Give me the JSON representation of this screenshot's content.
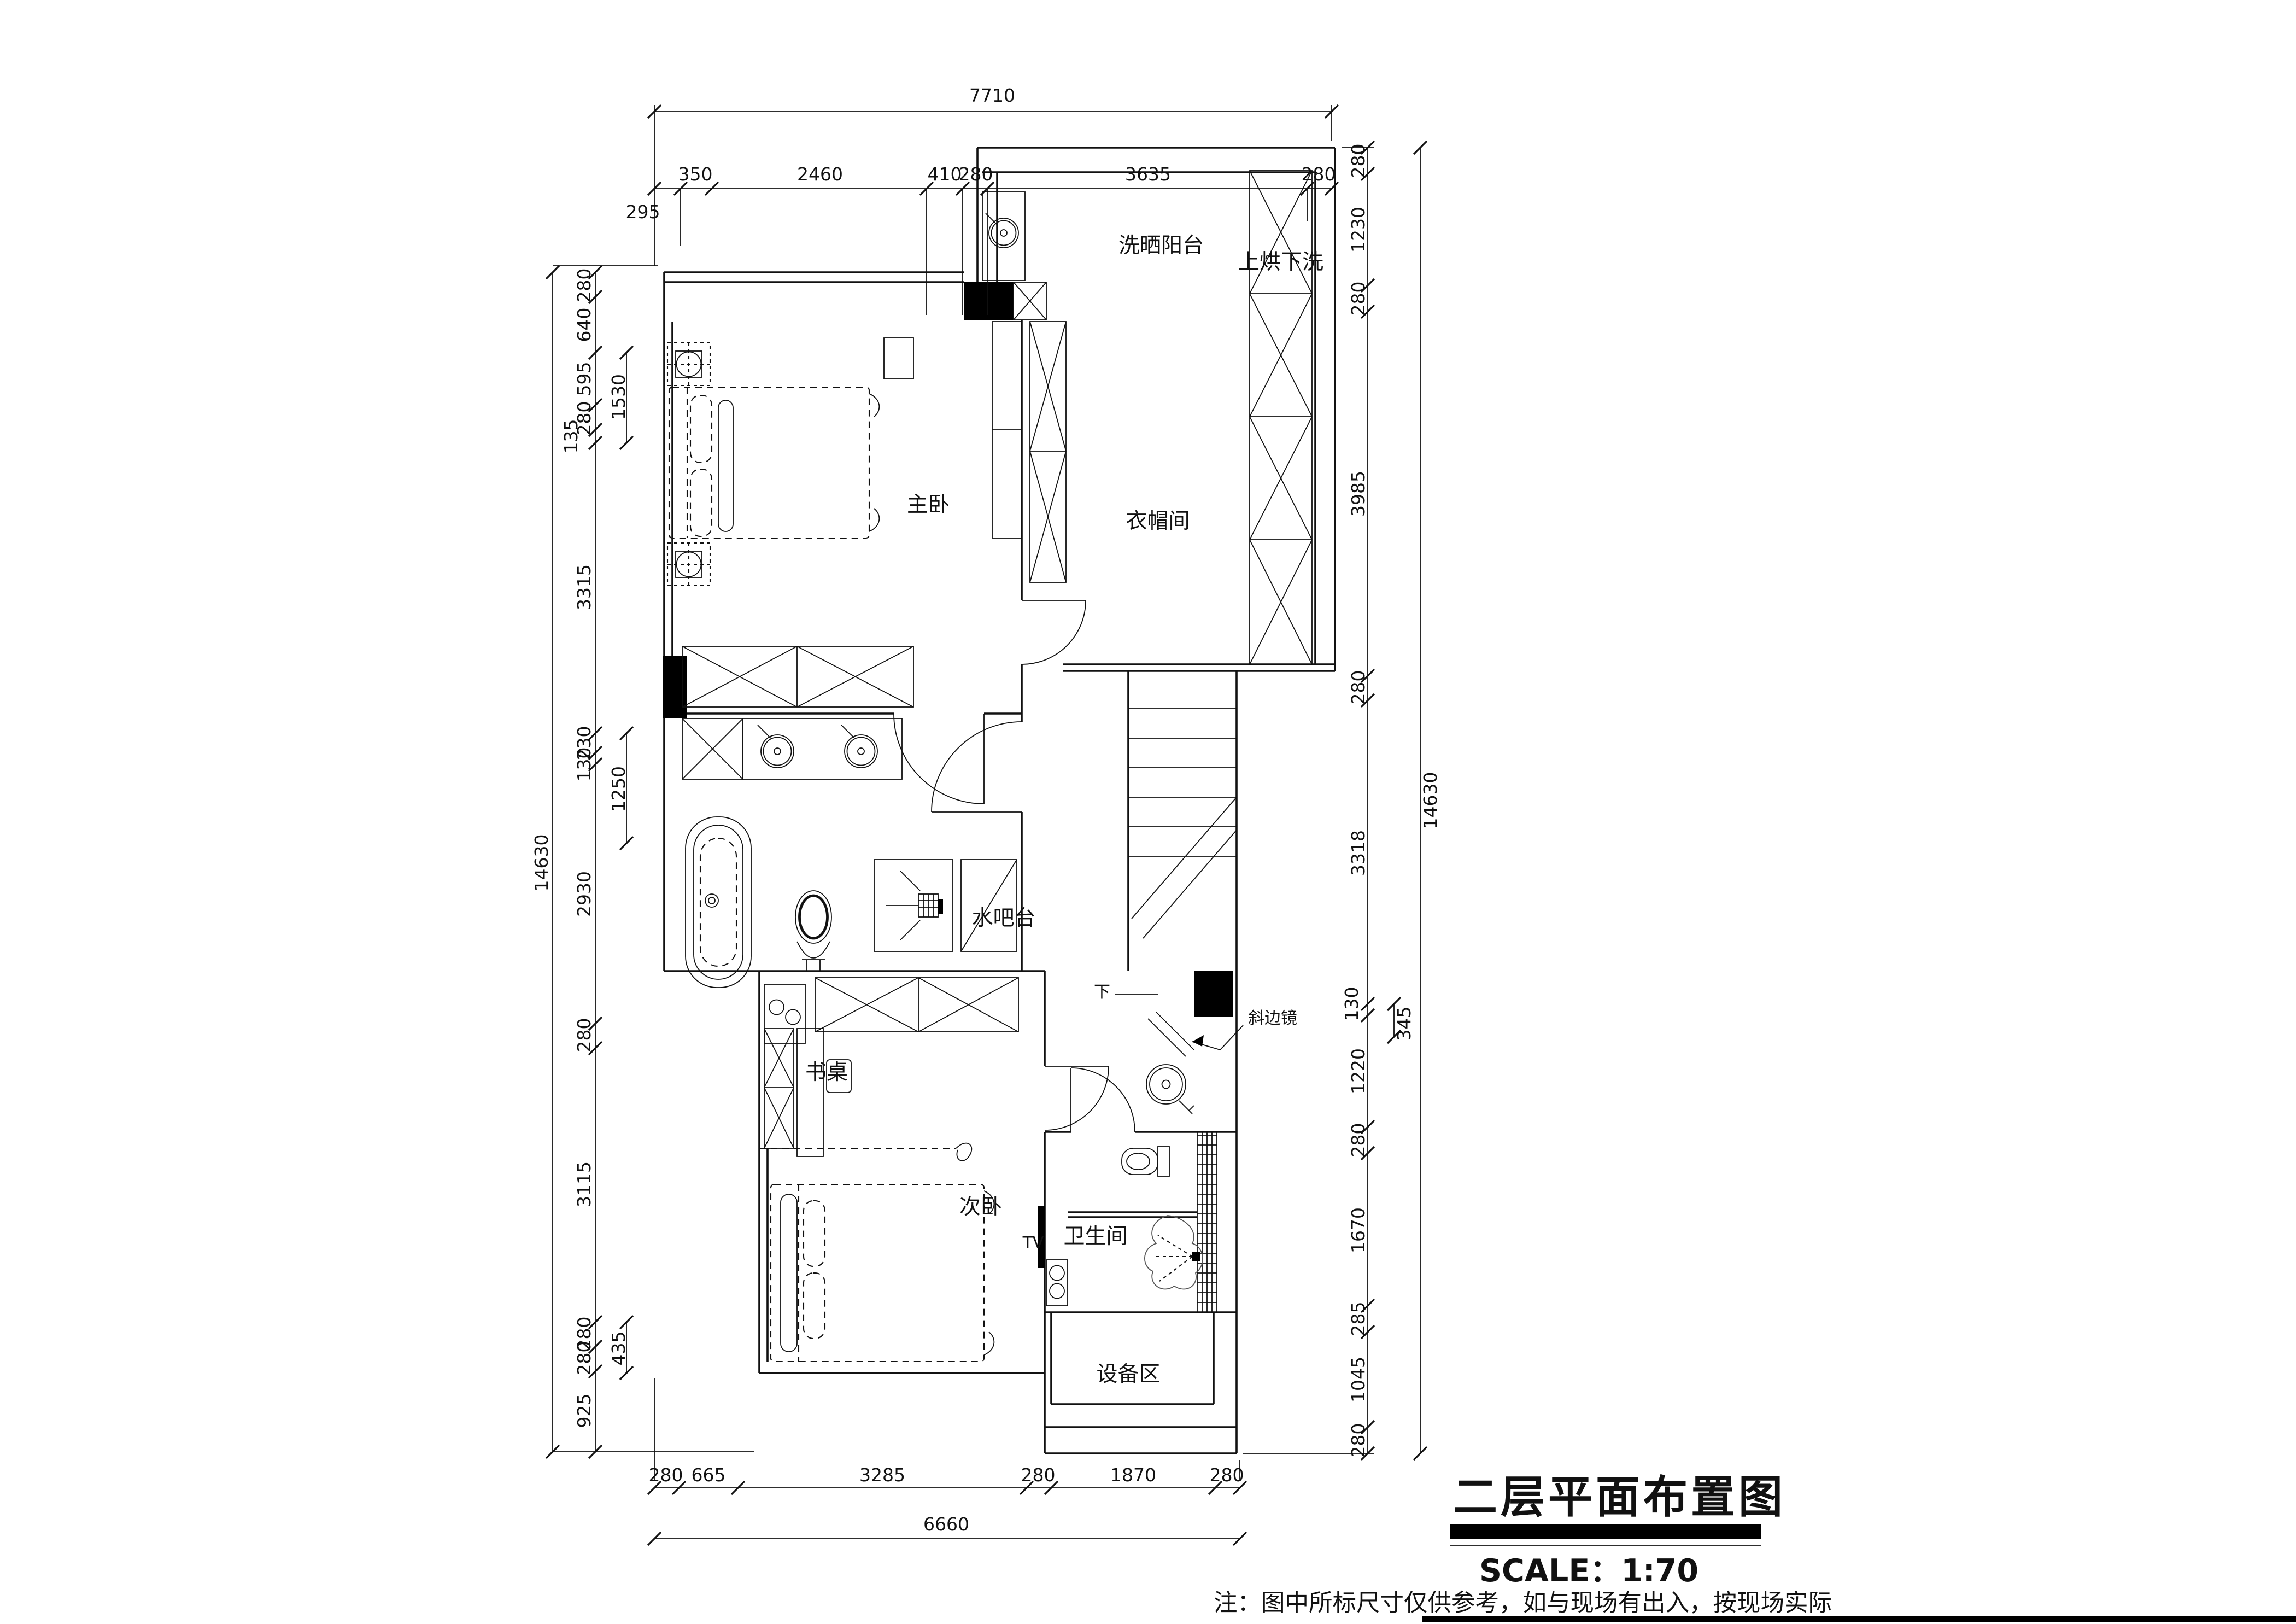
{
  "drawing": {
    "title": "二层平面布置图",
    "scale_label": "SCALE：1:70",
    "note": "注：图中所标尺寸仅供参考，如与现场有出入，按现场实际"
  },
  "rooms": {
    "laundry_balcony": "洗晒阳台",
    "washer_dryer_stack": "上烘下洗",
    "master_bedroom": "主卧",
    "walk_in_closet": "衣帽间",
    "water_bar": "水吧台",
    "desk": "书桌",
    "second_bedroom": "次卧",
    "tv": "TV",
    "bathroom": "卫生间",
    "equipment_area": "设备区",
    "beveled_mirror": "斜边镜",
    "stairs_down": "下"
  },
  "dimensions": {
    "top": {
      "overall": "7710",
      "segments": [
        "295",
        "350",
        "2460",
        "410",
        "280",
        "3635",
        "280"
      ]
    },
    "left": {
      "overall": "14630",
      "segments": [
        "280",
        "640",
        "595",
        "280",
        "135",
        "3315",
        "230",
        "130",
        "2930",
        "280",
        "3115",
        "280",
        "280",
        "925"
      ],
      "inner": [
        "1530",
        "1250",
        "435"
      ]
    },
    "right": {
      "overall": "14630",
      "segments": [
        "280",
        "1230",
        "280",
        "3985",
        "280",
        "3318",
        "130",
        "1220",
        "280",
        "1670",
        "285",
        "1045",
        "280"
      ],
      "inner": [
        "345"
      ]
    },
    "bottom": {
      "overall": "6660",
      "segments": [
        "280",
        "665",
        "3285",
        "280",
        "1870",
        "280"
      ]
    }
  }
}
